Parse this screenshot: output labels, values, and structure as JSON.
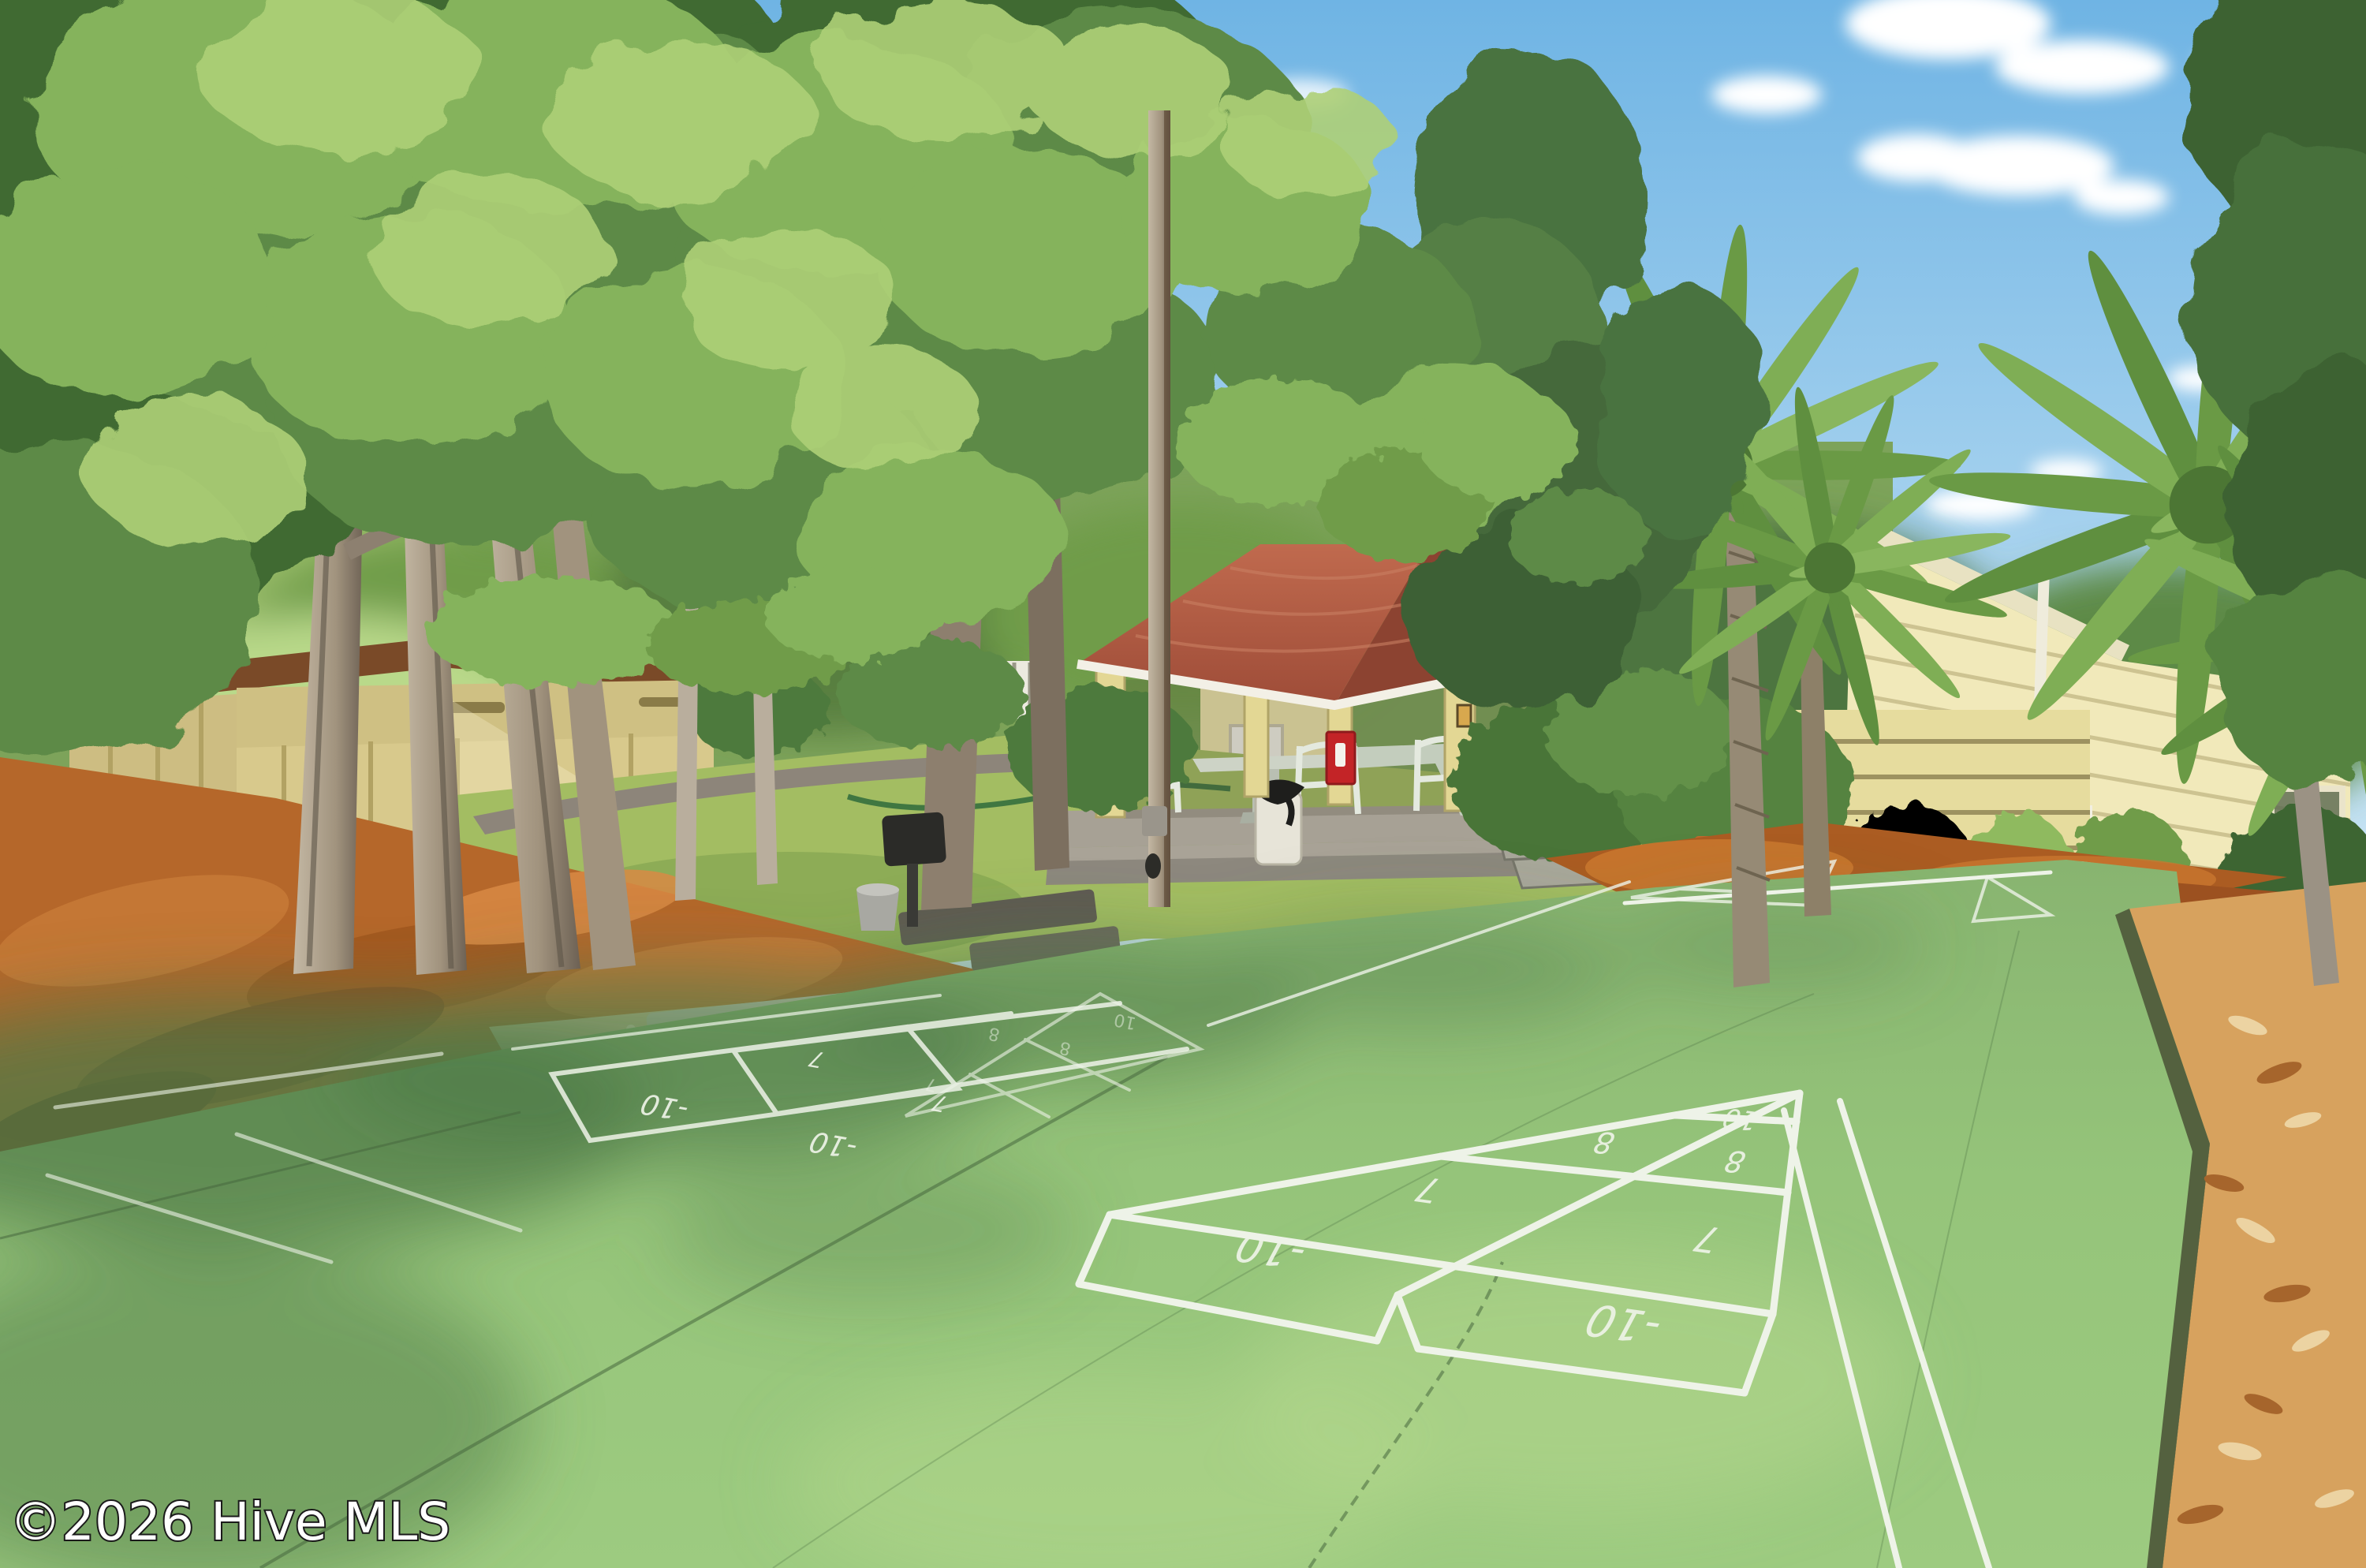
{
  "watermark": {
    "text": "©2026 Hive MLS"
  },
  "shed": {
    "sign_text": "1326"
  },
  "court": {
    "near_labels": [
      "10",
      "8",
      "8",
      "7",
      "7",
      "-10",
      "-10"
    ],
    "mid_labels": [
      "-10",
      "-10",
      "7",
      "7"
    ],
    "far_labels": [
      "10",
      "8",
      "8",
      "7"
    ]
  },
  "colors": {
    "sky_top": "#6fb4e4",
    "sky_low": "#d8edf8",
    "cloud_white": "#ffffff",
    "canopy_dark": "#3f6a33",
    "canopy_mid": "#5d8a46",
    "canopy_light": "#85b35c",
    "canopy_sun": "#aed077",
    "court_green": "#95c47a",
    "court_shade": "#4f7a48",
    "court_line": "#eef3e8",
    "grass_green": "#a3bd62",
    "mulch_orange": "#b5672a",
    "mulch_dark": "#8a4a1e",
    "chips_light": "#d7a25e",
    "gravel_tan": "#d7c49b",
    "roof_red": "#b05a41",
    "roof_dark": "#8c4331",
    "gazebo_cream": "#e3d794",
    "slab_gray": "#a7a195",
    "house_yellow": "#f1e9ba",
    "trim_white": "#f6f3e7",
    "shed_tan": "#d8c98c",
    "shed_roof_brown": "#7a4a28",
    "outbuilding_white": "#efeee3",
    "outbuilding_blue": "#4f93cc",
    "trunk_light": "#b3a692",
    "trunk_dark": "#6d6154",
    "pole_brown": "#8a6b50",
    "extinguisher_red": "#c32427",
    "sign_bg": "#1d1d1b",
    "sign_text_color": "#f2f2ee",
    "watermark_white": "#ffffff"
  }
}
